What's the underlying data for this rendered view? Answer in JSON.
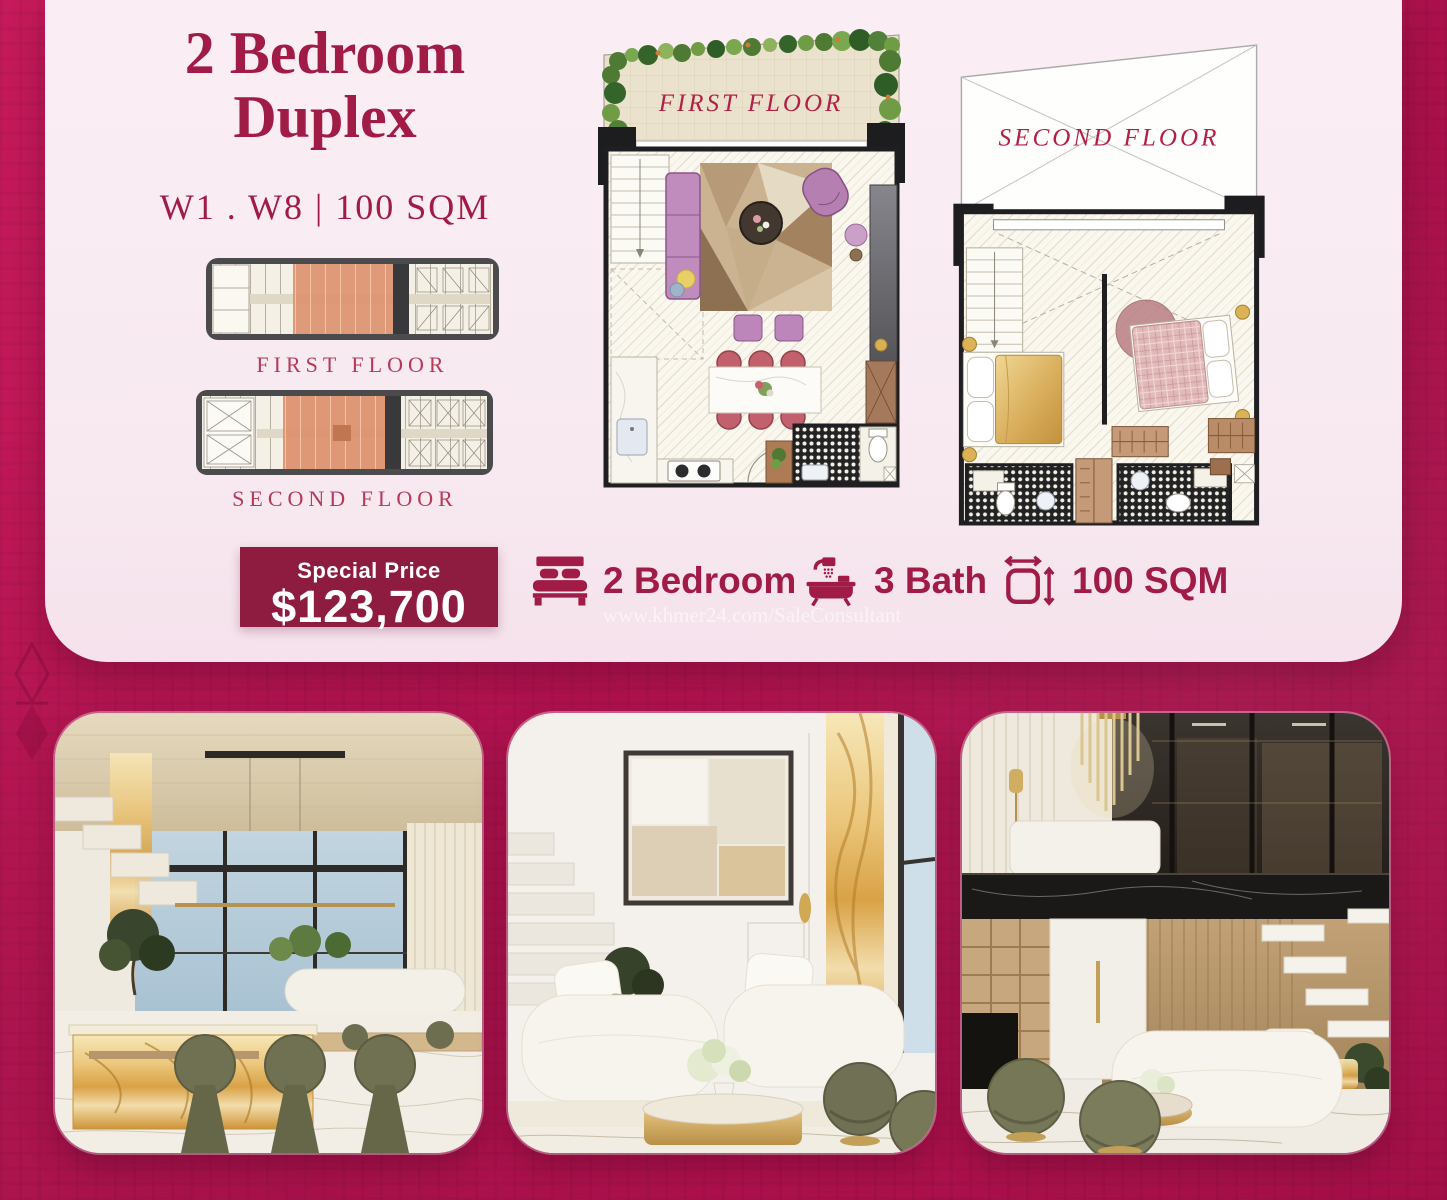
{
  "header": {
    "title_line1": "2 Bedroom",
    "title_line2": "Duplex",
    "subtitle": "W1 . W8 | 100 SQM"
  },
  "mini_plans": {
    "first_label": "FIRST FLOOR",
    "second_label": "SECOND FLOOR"
  },
  "large_plans": {
    "first_label": "FIRST FLOOR",
    "second_label": "SECOND FLOOR"
  },
  "price": {
    "label": "Special Price",
    "value": "$123,700"
  },
  "features": {
    "bedroom": {
      "icon": "bed-icon",
      "label": "2 Bedroom"
    },
    "bath": {
      "icon": "bath-icon",
      "label": "3 Bath"
    },
    "area": {
      "icon": "area-icon",
      "label": "100 SQM"
    }
  },
  "watermark": "www.khmer24.com/SaleConsultant",
  "colors": {
    "background": "#b5164f",
    "card": "#f8e9f0",
    "accent": "#a01b45",
    "badge": "#8e1c41",
    "plan_highlight": "#dc9270",
    "plan_label": "#b22045"
  },
  "photos": {
    "left": "dining-area-render",
    "middle": "living-room-render",
    "right": "duplex-loft-render"
  }
}
